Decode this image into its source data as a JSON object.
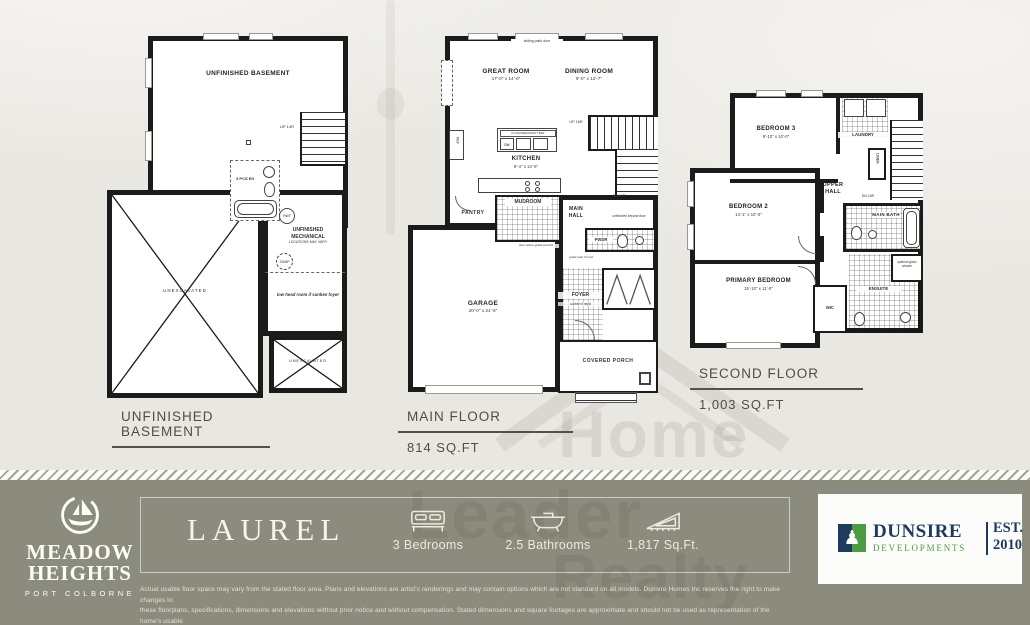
{
  "watermark": {
    "line1": "Home",
    "line2": "Leader",
    "line3": "Realty"
  },
  "basement": {
    "title": "UNFINISHED BASEMENT",
    "room": "UNFINISHED BASEMENT",
    "up": "UP 14R",
    "bath": "3 PCS R/I",
    "hwt": "HWT",
    "mech_l1": "UNFINISHED",
    "mech_l2": "MECHANICAL",
    "mech_note": "LOCATIONS MAY VARY",
    "sump": "SUMP",
    "low_head": "low head room if sunken foyer",
    "unexcavated": "UNEXCAVATED"
  },
  "main_floor": {
    "title": "MAIN FLOOR",
    "sqft": "814 SQ.FT",
    "patio": "sliding patio door",
    "great": {
      "name": "GREAT ROOM",
      "dims": "17'-0\" x 14'-0\""
    },
    "dining": {
      "name": "DINING ROOM",
      "dims": "9'-0\" x 12'-7\""
    },
    "kitchen": {
      "name": "KITCHEN",
      "dims": "9'-4\" x 14'-6\""
    },
    "bar": "FLUSH BREAKFAST BAR",
    "dw": "DW",
    "ref": "REF",
    "pantry": "PANTRY",
    "mudroom": "MUDROOM",
    "hall": "MAIN HALL",
    "up": "UP 16R",
    "dn": "DN 14R",
    "unfinished": "unfinished beyond door",
    "grade_door": "door where grade permits",
    "grade_stair": "grade stair if req'd",
    "pwdr": "PWDR",
    "foyer": "FOYER",
    "sunken": "sunken if req'd",
    "garage": {
      "name": "GARAGE",
      "dims": "20'-0\" x 21'-6\""
    },
    "porch": "COVERED PORCH"
  },
  "second_floor": {
    "title": "SECOND FLOOR",
    "sqft": "1,003 SQ.FT",
    "bed3": {
      "name": "BEDROOM 3",
      "dims": "9'-10\" x 10'-0\""
    },
    "laundry": "LAUNDRY",
    "linen": "LINEN",
    "hall": "UPPER HALL",
    "dn": "DN 16R",
    "bed2": {
      "name": "BEDROOM 2",
      "dims": "14'-1\" x 10'-0\""
    },
    "bath": "MAIN BATH",
    "primary": {
      "name": "PRIMARY BEDROOM",
      "dims": "15'-10\" x 11'-0\""
    },
    "wic": "WIC",
    "ensuite": "ENSUITE",
    "shower": "optional glass shower"
  },
  "banner": {
    "community": {
      "name1": "MEADOW",
      "name2": "HEIGHTS",
      "location": "PORT COLBORNE"
    },
    "model_name": "LAUREL",
    "specs": [
      {
        "icon": "bed-icon",
        "label": "3 Bedrooms"
      },
      {
        "icon": "bathtub-icon",
        "label": "2.5 Bathrooms"
      },
      {
        "icon": "area-icon",
        "label": "1,817 Sq.Ft."
      }
    ],
    "developer": {
      "name": "DUNSIRE",
      "sub": "DEVELOPMENTS",
      "est": "EST.",
      "year": "2010"
    },
    "disclaimer": [
      "Actual usable floor space may vary from the stated floor area. Plans and elevations are artist's renderings and may contain options which are not standard on all models. Dunsire Homes Inc reserves the right to make changes to",
      "these floorplans, specifications, dimensions and elevations without prior notice and without compensation. Stated dimensions and square footages are approximate and should not be used as representation of the home's usable",
      "floor space or actual size. Any square footage of a single-family home or a multi-family home that is stated herein is approximate only, may vary from time to time, and remains subject to change without notice or compensation"
    ]
  },
  "colors": {
    "banner_bg": "#8c8c7e",
    "dunsire_navy": "#1d3a5f",
    "dunsire_green": "#4d9b43",
    "wall": "#1b1b1b"
  }
}
